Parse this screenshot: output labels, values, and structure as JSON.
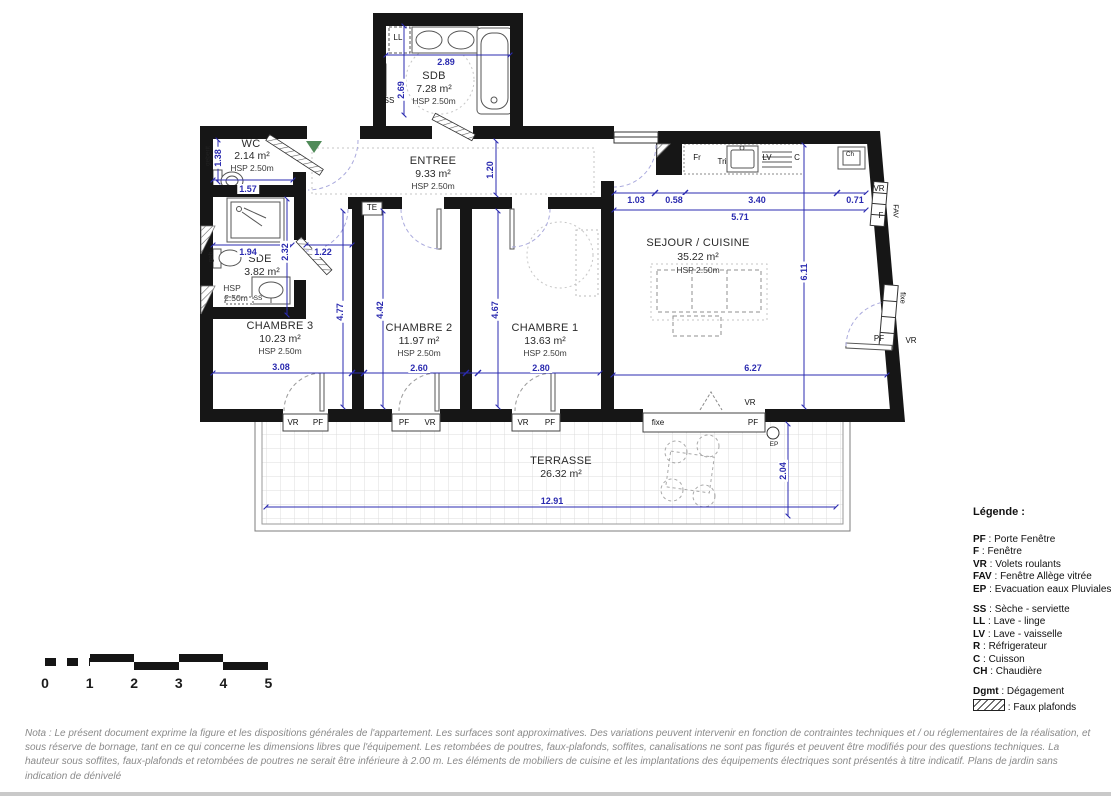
{
  "colors": {
    "wall_black": "#161616",
    "dimension_blue": "#2b2bb0",
    "entry_arrow_green": "#4f8a58",
    "door_arc_lavender": "#aaaadd",
    "nota_gray": "#8a8a8a"
  },
  "rooms": {
    "sdb": {
      "name": "SDB",
      "area": "7.28 m²",
      "hsp": "HSP 2.50m"
    },
    "wc": {
      "name": "WC",
      "area": "2.14 m²",
      "hsp": "HSP 2.50m"
    },
    "entree": {
      "name": "ENTREE",
      "area": "9.33 m²",
      "hsp": "HSP 2.50m"
    },
    "sde": {
      "name": "SDE",
      "area": "3.82 m²",
      "hsp_l1": "HSP",
      "hsp_l2": "2.50m"
    },
    "sejour": {
      "name": "SEJOUR / CUISINE",
      "area": "35.22 m²",
      "hsp": "HSP 2.50m"
    },
    "ch3": {
      "name": "CHAMBRE 3",
      "area": "10.23 m²",
      "hsp": "HSP 2.50m"
    },
    "ch2": {
      "name": "CHAMBRE 2",
      "area": "11.97 m²",
      "hsp": "HSP 2.50m"
    },
    "ch1": {
      "name": "CHAMBRE 1",
      "area": "13.63 m²",
      "hsp": "HSP 2.50m"
    },
    "terrasse": {
      "name": "TERRASSE",
      "area": "26.32 m²"
    }
  },
  "dims": {
    "sdb_w": "2.89",
    "sdb_h": "2.69",
    "wc_h": "1.38",
    "wc_w": "1.57",
    "hall": "1.20",
    "kit_1": "1.03",
    "kit_2": "0.58",
    "kit_3": "3.40",
    "kit_4": "0.71",
    "kit_total": "5.71",
    "sejour_h": "6.11",
    "sejour_w": "6.27",
    "sde_1": "1.94",
    "sde_h": "2.32",
    "sde_2": "1.22",
    "ch3_h": "4.77",
    "ch2_h": "4.42",
    "ch1_h": "4.67",
    "ch3_w": "3.08",
    "ch2_w": "2.60",
    "ch1_w": "2.80",
    "ter_w": "12.91",
    "ter_h": "2.04"
  },
  "labels": {
    "ll": "LL",
    "ss": "SS",
    "geberit": "geberit",
    "geb": "geb",
    "te": "TE",
    "fr": "Fr",
    "tri": "Tri",
    "lv": "LV",
    "c": "C",
    "ch": "Ch",
    "vr": "VR",
    "pf": "PF",
    "f": "F",
    "fav": "FAV",
    "fixe": "fixe",
    "ep": "EP"
  },
  "legend": {
    "title": "Légende :",
    "sep": " : ",
    "items1": [
      {
        "k": "PF",
        "v": "Porte Fenêtre"
      },
      {
        "k": "F",
        "v": "Fenêtre"
      },
      {
        "k": "VR",
        "v": "Volets roulants"
      },
      {
        "k": "FAV",
        "v": "Fenêtre Allège vitrée"
      },
      {
        "k": "EP",
        "v": "Evacuation eaux Pluviales"
      }
    ],
    "items2": [
      {
        "k": "SS",
        "v": "Sèche - serviette"
      },
      {
        "k": "LL",
        "v": "Lave - linge"
      },
      {
        "k": "LV",
        "v": "Lave - vaisselle"
      },
      {
        "k": "R",
        "v": "Réfrigerateur"
      },
      {
        "k": "C",
        "v": "Cuisson"
      },
      {
        "k": "CH",
        "v": "Chaudière"
      }
    ],
    "dgmt_k": "Dgmt",
    "dgmt_v": "Dégagement",
    "faux": "Faux plafonds"
  },
  "scale": {
    "ticks": [
      "0",
      "1",
      "2",
      "3",
      "4",
      "5"
    ]
  },
  "nota": "Nota : Le présent document exprime la figure et les dispositions générales de l'appartement. Les surfaces sont approximatives. Des variations peuvent intervenir en fonction de contraintes techniques et / ou réglementaires de la réalisation, et sous réserve de bornage, tant en ce qui concerne les dimensions libres que l'équipement. Les retombées de poutres, faux-plafonds, soffites, canalisations ne sont pas figurés et peuvent être modifiés pour des questions techniques. La hauteur sous soffites, faux-plafonds et retombées de poutres ne serait être inférieure à 2.00 m. Les éléments de mobiliers de cuisine et les implantations des équipements électriques sont présentés à titre indicatif. Plans de jardin sans indication de dénivelé"
}
